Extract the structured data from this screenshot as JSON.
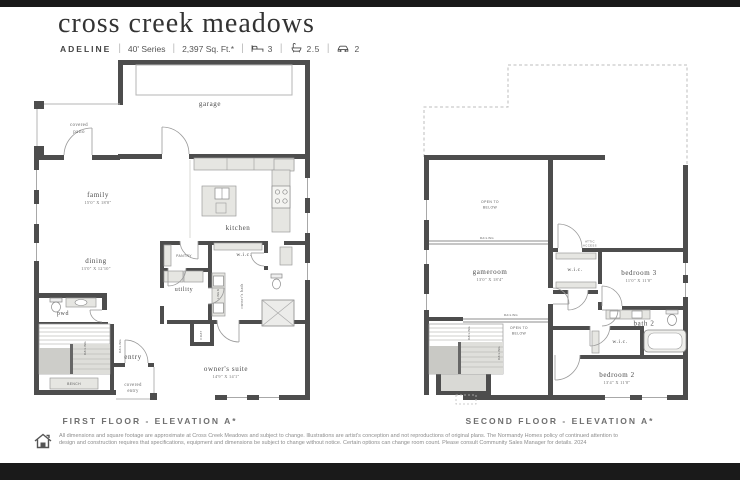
{
  "header": {
    "title": "cross creek meadows",
    "plan_name": "ADELINE",
    "series": "40' Series",
    "sqft": "2,397 Sq. Ft.*",
    "beds": "3",
    "baths": "2.5",
    "cars": "2",
    "sep": "|"
  },
  "f1": {
    "caption": "FIRST FLOOR - ELEVATION A*",
    "garage": "garage",
    "covered_patio_l1": "covered",
    "covered_patio_l2": "patio",
    "family": "family",
    "family_dim": "15'0\" X 18'0\"",
    "kitchen": "kitchen",
    "dining": "dining",
    "dining_dim": "13'0\" X 12'10\"",
    "pantry": "PANTRY",
    "wic": "w.i.c.",
    "utility": "utility",
    "owners_bath": "owner's bath",
    "linen": "LINEN",
    "pwd": "pwd",
    "coat": "COAT",
    "entry": "entry",
    "covered_entry_l1": "covered",
    "covered_entry_l2": "entry",
    "bench": "BENCH",
    "railing": "RAILING",
    "owners_suite": "owner's suite",
    "owners_suite_dim": "14'9\" X 14'1\""
  },
  "f2": {
    "caption": "SECOND FLOOR - ELEVATION A*",
    "open_below_l1": "OPEN TO",
    "open_below_l2": "BELOW",
    "railing": "RAILING",
    "gameroom": "gameroom",
    "gameroom_dim": "13'0\" X 18'4\"",
    "attic_l1": "ATTIC",
    "attic_l2": "ACCESS",
    "wic": "w.i.c.",
    "bedroom3": "bedroom 3",
    "bedroom3_dim": "11'0\" X 11'0\"",
    "bath2": "bath 2",
    "bedroom2": "bedroom 2",
    "bedroom2_dim": "13'4\" X 11'0\""
  },
  "footer": {
    "disclaimer_line1": "All dimensions and square footage are approximate at Cross Creek Meadows and subject to change. Illustrations are artist's conception and not reproductions of original plans. The Normandy Homes policy of continued attention to",
    "disclaimer_line2": "design and construction requires that specifications, equipment and dimensions be subject to change without notice. Certain options can change room count. Please consult Community Sales Manager for details. 2024"
  },
  "colors": {
    "wall": "#4d4d4d",
    "fixture": "#e6e6e2",
    "text": "#4a4a4a",
    "bars": "#1a1a1a"
  }
}
